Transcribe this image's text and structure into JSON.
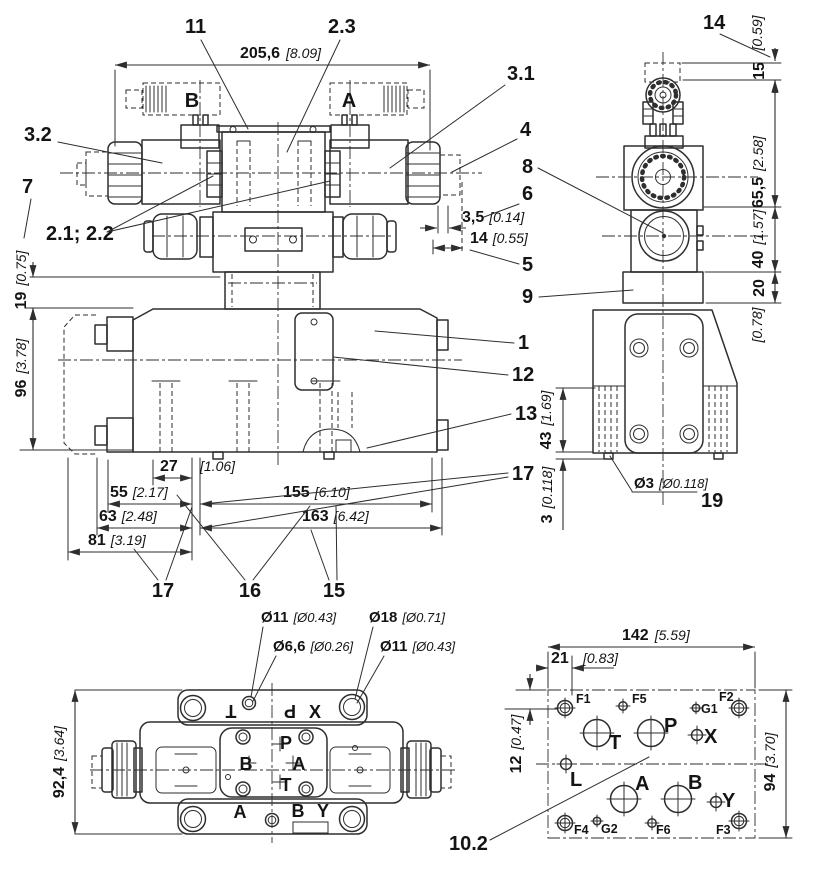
{
  "colors": {
    "line": "#2e2e2e",
    "text": "#141414"
  },
  "front": {
    "solenoids": {
      "b": "B",
      "a": "A"
    },
    "callouts": {
      "c11": "11",
      "c2_3": "2.3",
      "c3_1": "3.1",
      "c3_2": "3.2",
      "c7": "7",
      "c2_1_2_2": "2.1; 2.2",
      "c4": "4",
      "c8": "8",
      "c6": "6",
      "c5": "5",
      "c9": "9",
      "c1": "1",
      "c12": "12",
      "c13": "13",
      "c17_right": "17",
      "c17_bottom": "17",
      "c16": "16",
      "c15": "15"
    },
    "dims": {
      "width": {
        "mm": "205,6",
        "in": "[8.09]"
      },
      "d3_5": {
        "mm": "3,5",
        "in": "[0.14]"
      },
      "d14": {
        "mm": "14",
        "in": "[0.55]"
      },
      "d19": {
        "mm": "19",
        "in": "[0.75]"
      },
      "d96": {
        "mm": "96",
        "in": "[3.78]"
      },
      "d27": {
        "mm": "27",
        "in": "[1.06]"
      },
      "d55": {
        "mm": "55",
        "in": "[2.17]"
      },
      "d155": {
        "mm": "155",
        "in": "[6.10]"
      },
      "d63": {
        "mm": "63",
        "in": "[2.48]"
      },
      "d163": {
        "mm": "163",
        "in": "[6.42]"
      },
      "d81": {
        "mm": "81",
        "in": "[3.19]"
      }
    }
  },
  "side": {
    "callouts": {
      "c14": "14",
      "c19": "19"
    },
    "dims": {
      "d15": {
        "mm": "15",
        "in": "[0.59]"
      },
      "d65_5": {
        "mm": "65,5",
        "in": "[2.58]"
      },
      "d40": {
        "mm": "40",
        "in": "[1.57]"
      },
      "d20": {
        "mm": "20",
        "in": "[0.78]"
      },
      "d43": {
        "mm": "43",
        "in": "[1.69]"
      },
      "d3": {
        "mm": "3",
        "in": "[0.118]"
      },
      "dia3": {
        "mm": "Ø3",
        "in": "[Ø0.118]"
      }
    }
  },
  "bottom": {
    "dims": {
      "dia11_top": {
        "mm": "Ø11",
        "in": "[Ø0.43]"
      },
      "dia6_6": {
        "mm": "Ø6,6",
        "in": "[Ø0.26]"
      },
      "dia18": {
        "mm": "Ø18",
        "in": "[Ø0.71]"
      },
      "dia11_right": {
        "mm": "Ø11",
        "in": "[Ø0.43]"
      },
      "d92_4": {
        "mm": "92,4",
        "in": "[3.64]"
      }
    },
    "ports": {
      "t_rot": "T",
      "p_rot": "P",
      "x": "X",
      "p": "P",
      "b": "B",
      "a": "A",
      "t": "T",
      "a2": "A",
      "b2": "B",
      "y": "Y"
    }
  },
  "pattern": {
    "callouts": {
      "c10_2": "10.2"
    },
    "dims": {
      "d142": {
        "mm": "142",
        "in": "[5.59]"
      },
      "d21": {
        "mm": "21",
        "in": "[0.83]"
      },
      "d12": {
        "mm": "12",
        "in": "[0.47]"
      },
      "d94": {
        "mm": "94",
        "in": "[3.70]"
      }
    },
    "ports": {
      "f1": "F1",
      "f5": "F5",
      "g1": "G1",
      "f2": "F2",
      "t": "T",
      "p": "P",
      "x": "X",
      "l": "L",
      "a": "A",
      "b": "B",
      "y": "Y",
      "f4": "F4",
      "g2": "G2",
      "f6": "F6",
      "f3": "F3"
    }
  }
}
